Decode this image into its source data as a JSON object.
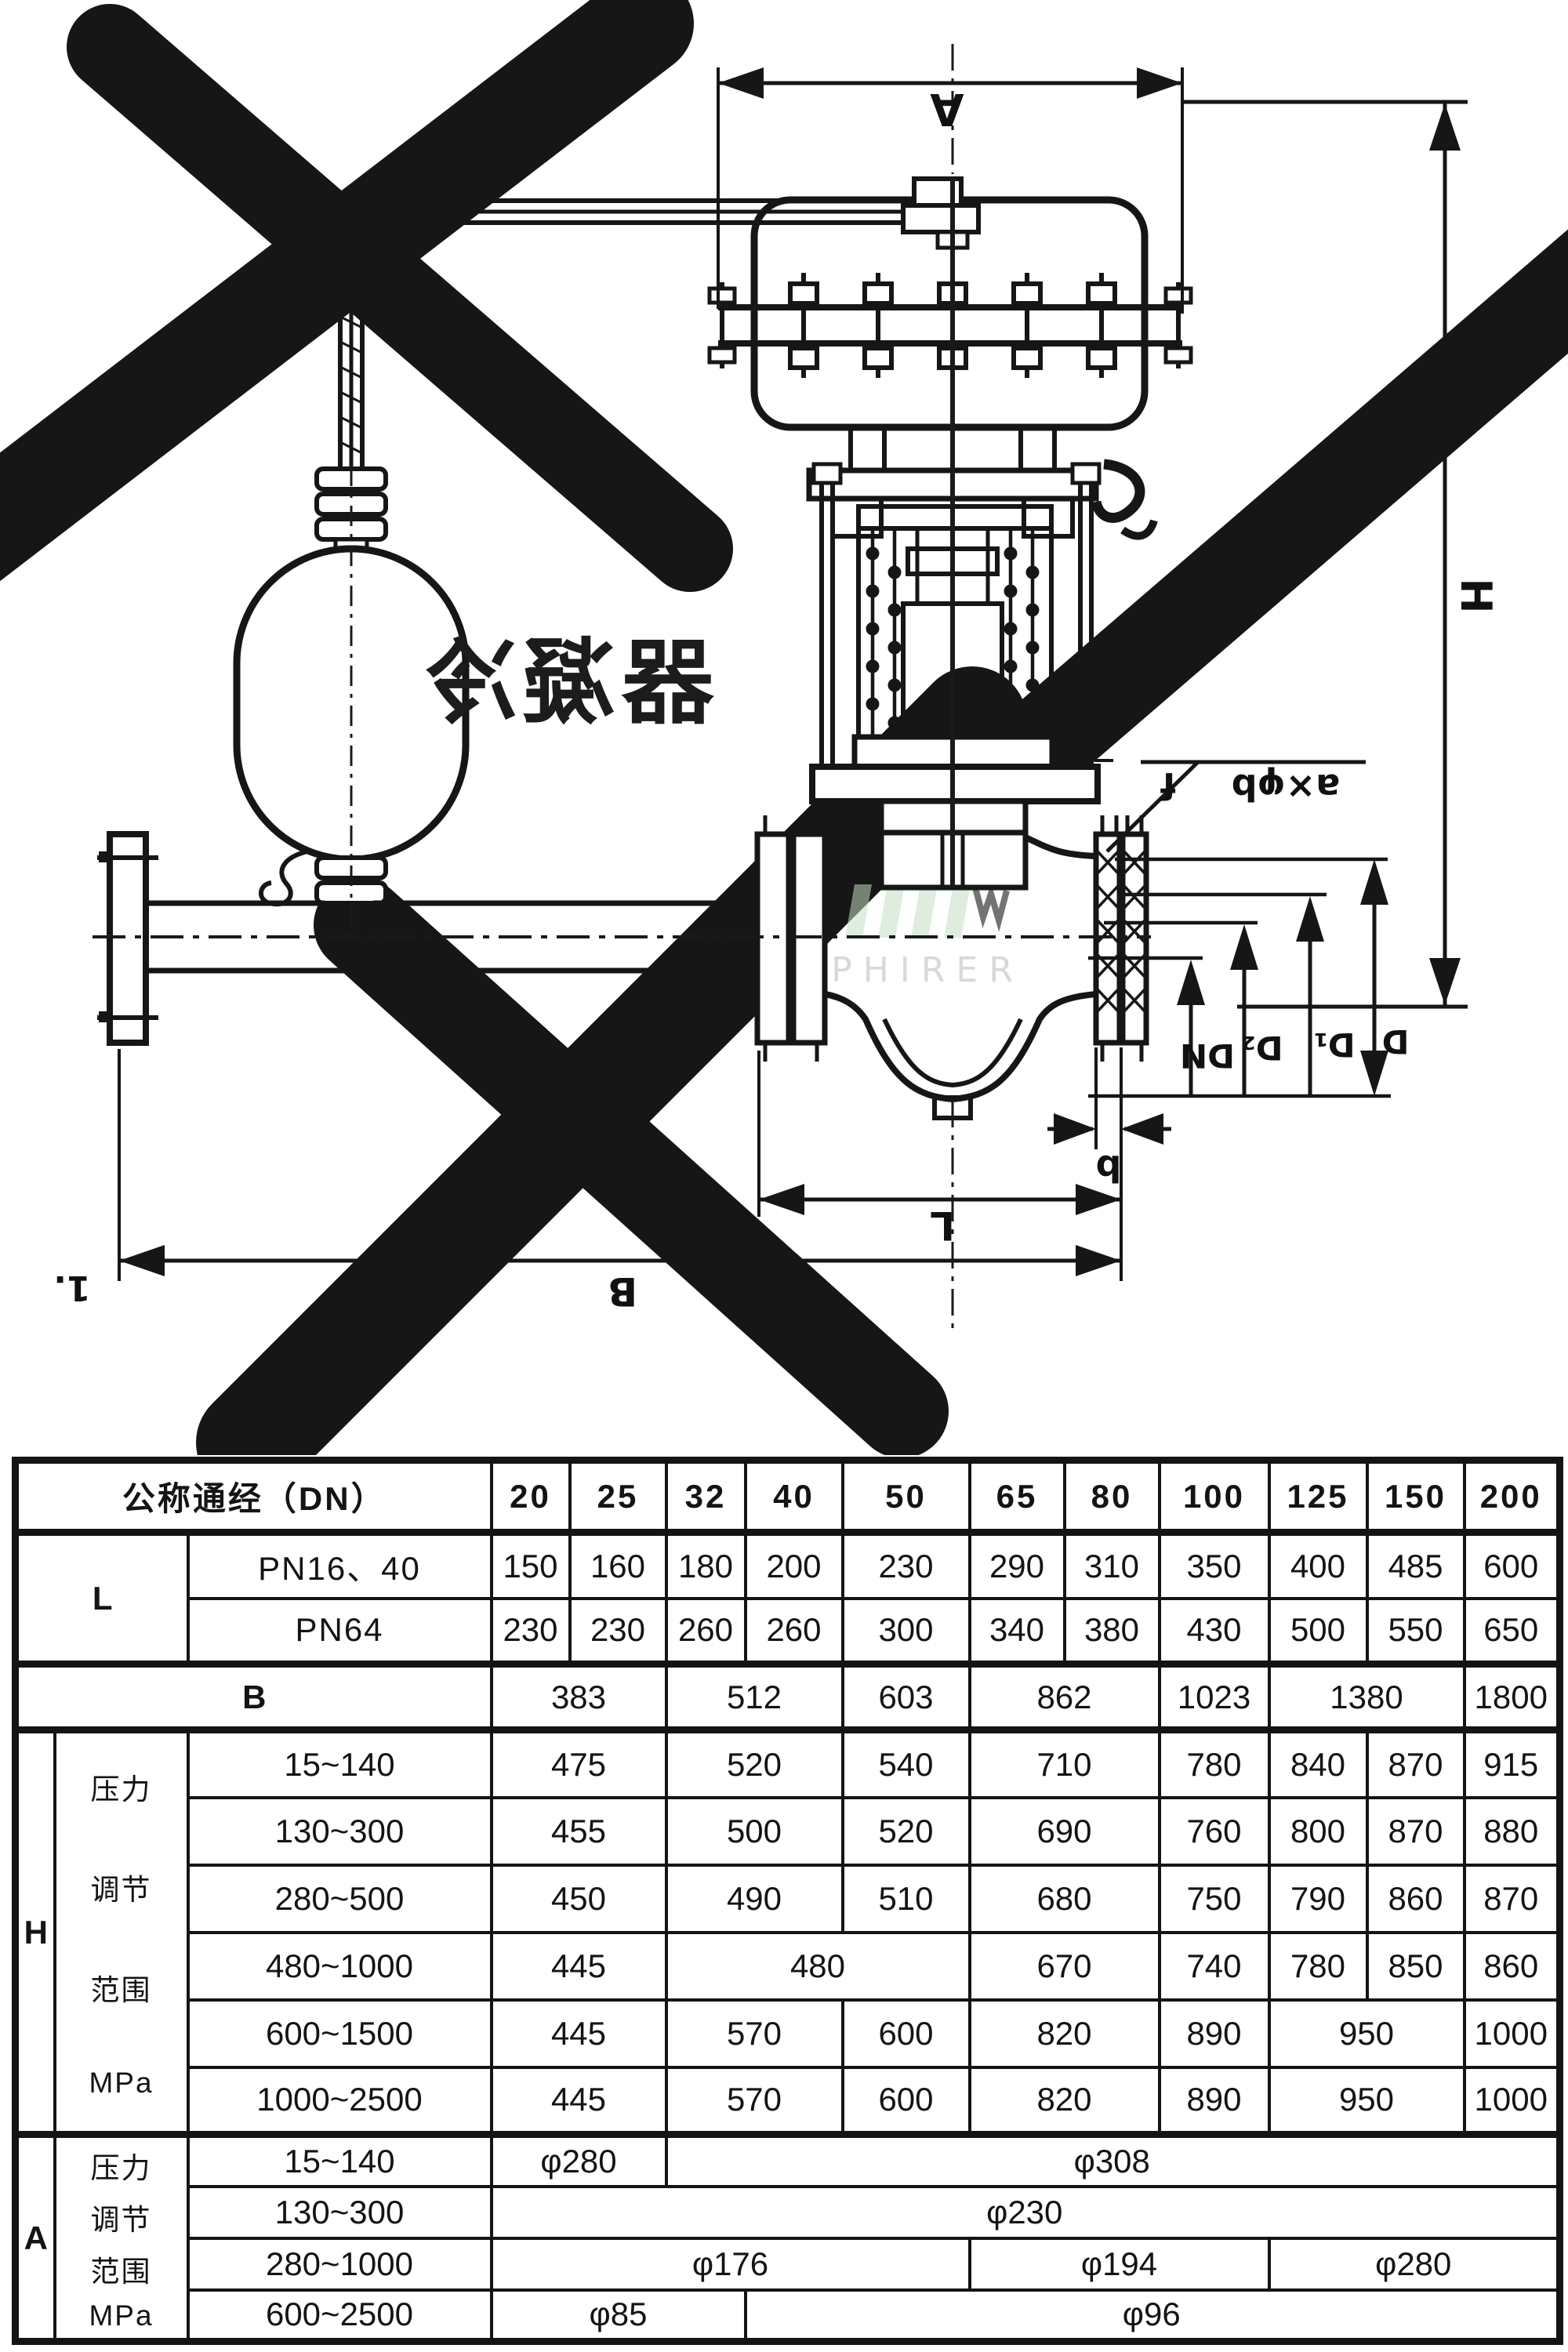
{
  "diagram": {
    "condenser_label": "冷凝器",
    "dims": {
      "A": "A",
      "H": "H",
      "f": "f",
      "bolt_callout": "a×φb",
      "DN": "DN",
      "D2": "D₂",
      "D1": "D₁",
      "D": "D",
      "b": "b",
      "L": "L",
      "B": "B",
      "corner_mark": "1."
    },
    "watermark": {
      "logo_text": "PHIRER",
      "logo_green": "#c2dfc2",
      "faint_red": "#f0c2b8",
      "faint_gray": "#f0f0f0"
    },
    "ink_color": "#161616"
  },
  "table": {
    "rows": [
      {
        "type": "head",
        "cells": [
          {
            "t": "公称通经（DN）",
            "cs": 3,
            "cls": "hdr",
            "name": "col-header-dn"
          },
          {
            "t": "20",
            "cls": "hdr"
          },
          {
            "t": "25",
            "cls": "hdr"
          },
          {
            "t": "32",
            "cls": "hdr"
          },
          {
            "t": "40",
            "cls": "hdr"
          },
          {
            "t": "50",
            "cls": "hdr"
          },
          {
            "t": "65",
            "cls": "hdr"
          },
          {
            "t": "80",
            "cls": "hdr"
          },
          {
            "t": "100",
            "cls": "hdr"
          },
          {
            "t": "125",
            "cls": "hdr"
          },
          {
            "t": "150",
            "cls": "hdr"
          },
          {
            "t": "200",
            "cls": "hdr"
          }
        ]
      },
      {
        "type": "l",
        "sect": true,
        "cells": [
          {
            "t": "L",
            "rs": 2,
            "cs": 2,
            "cls": "big",
            "name": "row-label-L"
          },
          {
            "t": "PN16、40",
            "cls": "zh",
            "name": "row-label-pn16-40"
          },
          {
            "t": "150"
          },
          {
            "t": "160"
          },
          {
            "t": "180"
          },
          {
            "t": "200"
          },
          {
            "t": "230"
          },
          {
            "t": "290"
          },
          {
            "t": "310"
          },
          {
            "t": "350"
          },
          {
            "t": "400"
          },
          {
            "t": "485"
          },
          {
            "t": "600"
          }
        ]
      },
      {
        "type": "l",
        "cells": [
          {
            "t": "PN64",
            "cls": "zh",
            "name": "row-label-pn64"
          },
          {
            "t": "230"
          },
          {
            "t": "230"
          },
          {
            "t": "260"
          },
          {
            "t": "260"
          },
          {
            "t": "300"
          },
          {
            "t": "340"
          },
          {
            "t": "380"
          },
          {
            "t": "430"
          },
          {
            "t": "500"
          },
          {
            "t": "550"
          },
          {
            "t": "650"
          }
        ]
      },
      {
        "type": "b",
        "sect": true,
        "cells": [
          {
            "t": "B",
            "cs": 3,
            "cls": "big",
            "name": "row-label-B"
          },
          {
            "t": "383",
            "cs": 2
          },
          {
            "t": "512",
            "cs": 2
          },
          {
            "t": "603"
          },
          {
            "t": "862",
            "cs": 2
          },
          {
            "t": "1023"
          },
          {
            "t": "1380",
            "cs": 2
          },
          {
            "t": "1800"
          }
        ]
      },
      {
        "type": "h",
        "sect": true,
        "cells": [
          {
            "t": "H",
            "rs": 6,
            "cls": "big",
            "name": "row-label-H"
          },
          {
            "lines": [
              "压力",
              "调节",
              "范围",
              "MPa"
            ],
            "rs": 6,
            "cls": "zh stack6",
            "name": "pressure-range-label"
          },
          {
            "t": "15~140",
            "cls": "rng"
          },
          {
            "t": "475",
            "cs": 2
          },
          {
            "t": "520",
            "cs": 2
          },
          {
            "t": "540"
          },
          {
            "t": "710",
            "cs": 2
          },
          {
            "t": "780"
          },
          {
            "t": "840"
          },
          {
            "t": "870"
          },
          {
            "t": "915"
          }
        ]
      },
      {
        "type": "h",
        "cells": [
          {
            "t": "130~300",
            "cls": "rng"
          },
          {
            "t": "455",
            "cs": 2
          },
          {
            "t": "500",
            "cs": 2
          },
          {
            "t": "520"
          },
          {
            "t": "690",
            "cs": 2
          },
          {
            "t": "760"
          },
          {
            "t": "800"
          },
          {
            "t": "870"
          },
          {
            "t": "880"
          }
        ]
      },
      {
        "type": "h",
        "cells": [
          {
            "t": "280~500",
            "cls": "rng"
          },
          {
            "t": "450",
            "cs": 2
          },
          {
            "t": "490",
            "cs": 2
          },
          {
            "t": "510"
          },
          {
            "t": "680",
            "cs": 2
          },
          {
            "t": "750"
          },
          {
            "t": "790"
          },
          {
            "t": "860"
          },
          {
            "t": "870"
          }
        ]
      },
      {
        "type": "h",
        "cells": [
          {
            "t": "480~1000",
            "cls": "rng"
          },
          {
            "t": "445",
            "cs": 2
          },
          {
            "t": "480",
            "cs": 3
          },
          {
            "t": "670",
            "cs": 2
          },
          {
            "t": "740"
          },
          {
            "t": "780"
          },
          {
            "t": "850"
          },
          {
            "t": "860"
          }
        ]
      },
      {
        "type": "h",
        "cells": [
          {
            "t": "600~1500",
            "cls": "rng"
          },
          {
            "t": "445",
            "cs": 2
          },
          {
            "t": "570",
            "cs": 2
          },
          {
            "t": "600"
          },
          {
            "t": "820",
            "cs": 2
          },
          {
            "t": "890"
          },
          {
            "t": "950",
            "cs": 2
          },
          {
            "t": "1000"
          }
        ]
      },
      {
        "type": "h",
        "cells": [
          {
            "t": "1000~2500",
            "cls": "rng"
          },
          {
            "t": "445",
            "cs": 2
          },
          {
            "t": "570",
            "cs": 2
          },
          {
            "t": "600"
          },
          {
            "t": "820",
            "cs": 2
          },
          {
            "t": "890"
          },
          {
            "t": "950",
            "cs": 2
          },
          {
            "t": "1000"
          }
        ]
      },
      {
        "type": "a",
        "sect": true,
        "cells": [
          {
            "t": "A",
            "rs": 4,
            "cls": "big",
            "name": "row-label-A"
          },
          {
            "lines": [
              "压力",
              "调节",
              "范围",
              "MPa"
            ],
            "rs": 4,
            "cls": "zh stack4",
            "name": "pressure-range-label"
          },
          {
            "t": "15~140",
            "cls": "rng"
          },
          {
            "t": "φ280",
            "cs": 2
          },
          {
            "t": "φ308",
            "cs": 9
          }
        ]
      },
      {
        "type": "a",
        "cells": [
          {
            "t": "130~300",
            "cls": "rng"
          },
          {
            "t": "φ230",
            "cs": 11
          }
        ]
      },
      {
        "type": "a",
        "cells": [
          {
            "t": "280~1000",
            "cls": "rng"
          },
          {
            "t": "φ176",
            "cs": 5
          },
          {
            "t": "φ194",
            "cs": 3
          },
          {
            "t": "φ280",
            "cs": 3
          }
        ]
      },
      {
        "type": "a",
        "cells": [
          {
            "t": "600~2500",
            "cls": "rng"
          },
          {
            "t": "φ85",
            "cs": 3
          },
          {
            "t": "φ96",
            "cs": 8
          }
        ]
      }
    ]
  }
}
